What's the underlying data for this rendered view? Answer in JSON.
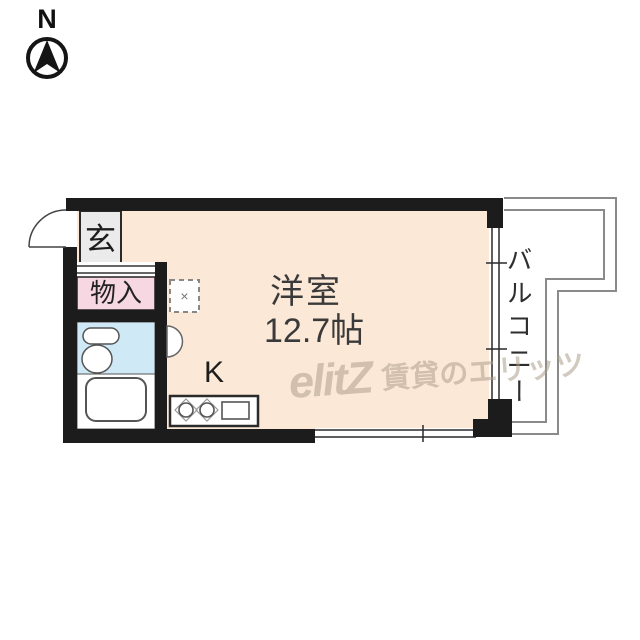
{
  "compass": {
    "label": "N"
  },
  "plan": {
    "entrance_label": "玄",
    "storage_label": "物入",
    "kitchen_label": "K",
    "room_label": "洋室",
    "room_size": "12.7帖",
    "balcony_label": "バルコニー",
    "washer_mark": "×"
  },
  "watermark": {
    "logo": "elitZ",
    "text": "賃貸のエリッツ"
  },
  "colors": {
    "wall": "#1c1c1c",
    "room_floor": "#fce8d7",
    "storage_fill": "#f7d7e2",
    "bath_wet_fill": "#cfe9f6",
    "entrance_fill": "#ebebeb",
    "balcony_line": "#8a8a8a"
  }
}
